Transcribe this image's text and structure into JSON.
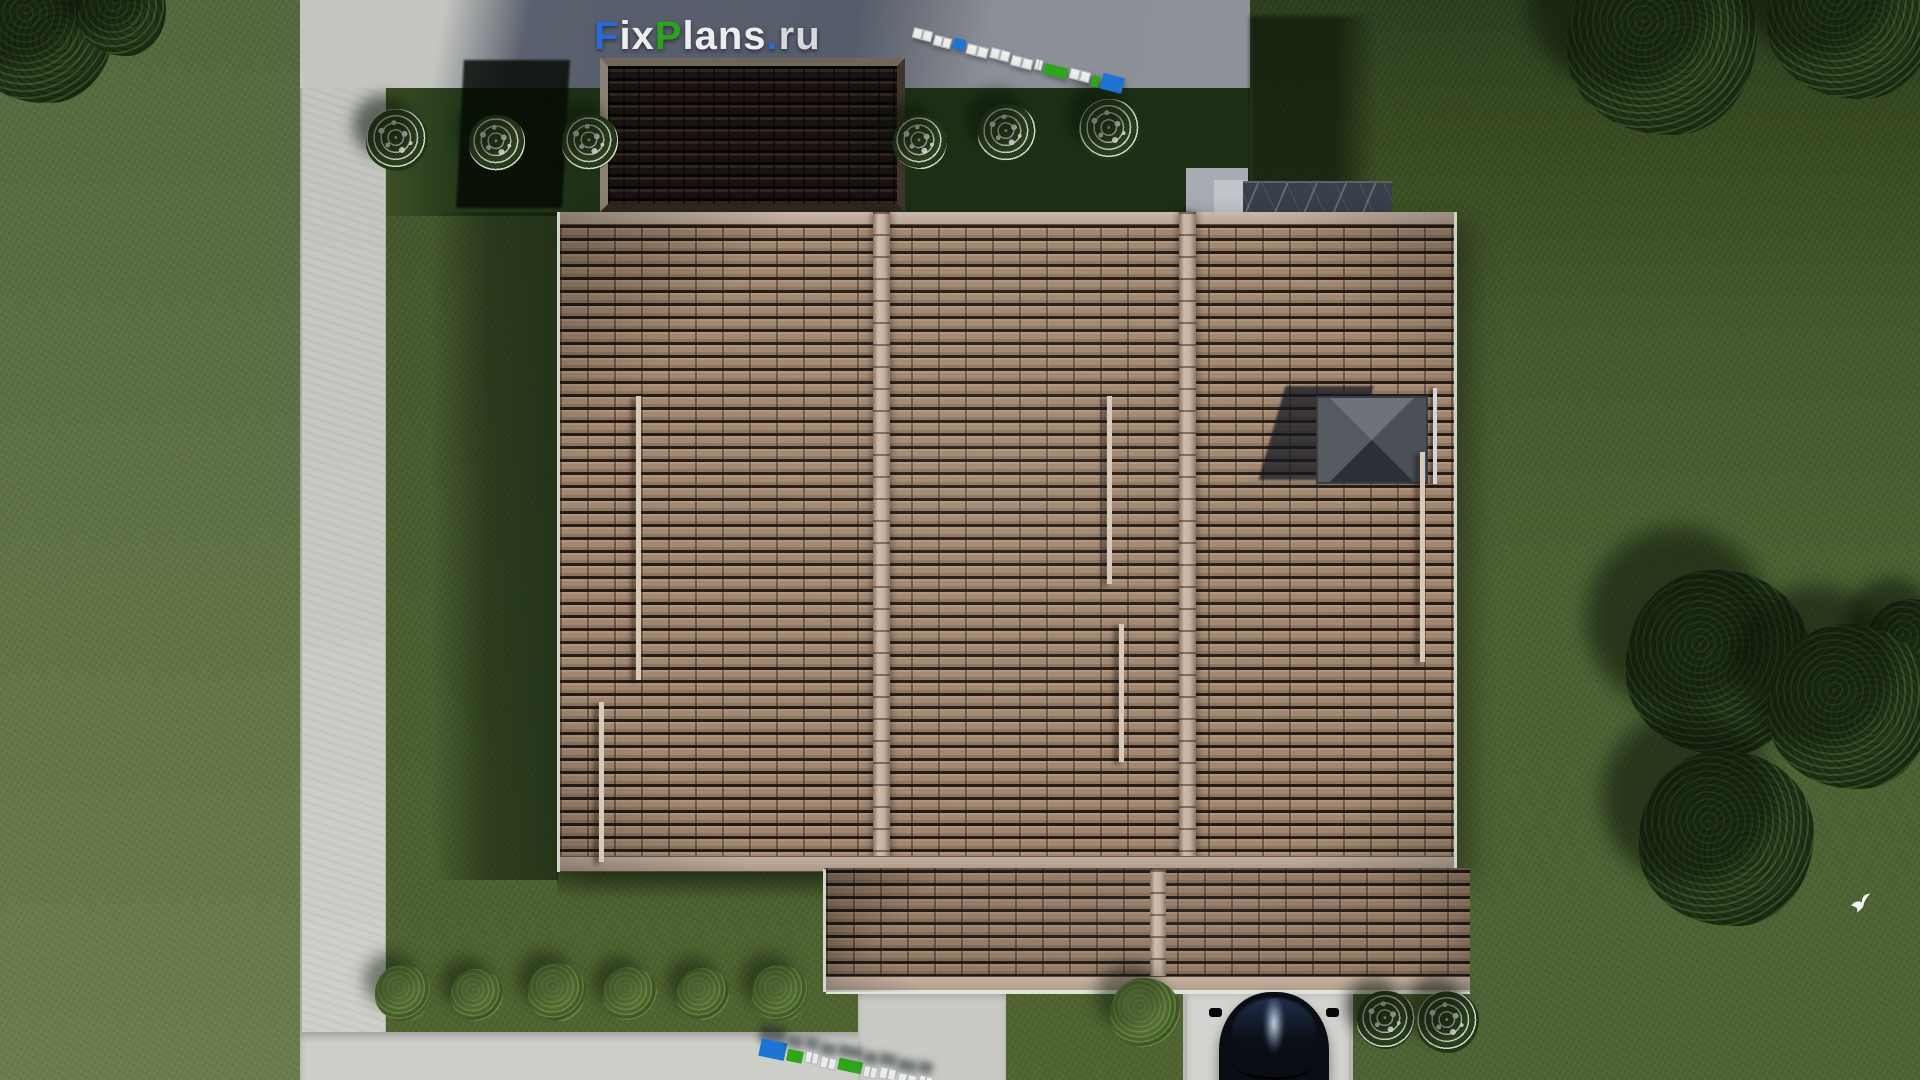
{
  "meta": {
    "canvas_width": 1920,
    "canvas_height": 1080,
    "description": "Aerial top-down 3D architectural render of a single-family house with a brown tiled hip roof, shadowed carport roof, landscaped lawn, concrete walkways, patio, driveway with parked dark car, trees and flowering bushes"
  },
  "watermark": {
    "text": "FixPlans.ru",
    "parts": [
      {
        "text": "F",
        "color": "#2a6ad4"
      },
      {
        "text": "ix",
        "color": "#ebedee"
      },
      {
        "text": "P",
        "color": "#2da21f"
      },
      {
        "text": "lans",
        "color": "#ebedee"
      },
      {
        "text": ".",
        "color": "#2a6ad4"
      },
      {
        "text": "ru",
        "color": "#d7d9dc"
      }
    ]
  },
  "palette": {
    "grass": "#4c6031",
    "grass_light": "#5f7244",
    "grass_shadow": "#1d3015",
    "concrete_path": "#c8c9c4",
    "terrace_dark": "#565c69",
    "roof_tile": "#a0846f",
    "roof_tile_highlight": "#b59a85",
    "roof_ridge": "#c9b6a6",
    "roof_gap": "#241c15",
    "carport_roof": "#191210",
    "marble_wall": "#394049",
    "car_body": "#0b0f16",
    "scalebar_blue": "#1e74d2",
    "scalebar_green": "#2fa51c",
    "scalebar_white": "#eff1ee"
  },
  "roof": {
    "snow_guards": [
      {
        "x": 636,
        "y": 396,
        "h": 284
      },
      {
        "x": 599,
        "y": 702,
        "h": 160
      },
      {
        "x": 1107,
        "y": 396,
        "h": 188
      },
      {
        "x": 1119,
        "y": 624,
        "h": 138
      },
      {
        "x": 1420,
        "y": 452,
        "h": 210
      }
    ],
    "chimney": {
      "x": 1318,
      "y": 398,
      "width": 108,
      "height": 84
    },
    "chimney_shadow": {
      "x": 1272,
      "y": 386,
      "width": 88,
      "height": 94
    },
    "vent_pipe": {
      "x": 1433,
      "y": 388,
      "height": 96
    }
  },
  "vegetation": {
    "trees": [
      {
        "x": 40,
        "y": 28,
        "s": 150
      },
      {
        "x": 122,
        "y": 12,
        "s": 88
      },
      {
        "x": 1662,
        "y": 40,
        "s": 190
      },
      {
        "x": 1852,
        "y": 14,
        "s": 170
      },
      {
        "x": 1912,
        "y": 645,
        "s": 92
      },
      {
        "x": 1718,
        "y": 662,
        "s": 185
      },
      {
        "x": 1850,
        "y": 706,
        "s": 165
      },
      {
        "x": 1726,
        "y": 838,
        "s": 175
      }
    ],
    "bushes": [
      {
        "x": 403,
        "y": 993,
        "s": 56
      },
      {
        "x": 477,
        "y": 995,
        "s": 52
      },
      {
        "x": 557,
        "y": 992,
        "s": 58
      },
      {
        "x": 630,
        "y": 994,
        "s": 54
      },
      {
        "x": 703,
        "y": 994,
        "s": 52
      },
      {
        "x": 780,
        "y": 993,
        "s": 56
      },
      {
        "x": 1145,
        "y": 1013,
        "s": 70
      }
    ],
    "flower_bushes": [
      {
        "x": 397,
        "y": 140,
        "s": 62
      },
      {
        "x": 497,
        "y": 143,
        "s": 56
      },
      {
        "x": 590,
        "y": 142,
        "s": 56
      },
      {
        "x": 920,
        "y": 142,
        "s": 54
      },
      {
        "x": 1007,
        "y": 133,
        "s": 58
      },
      {
        "x": 1110,
        "y": 130,
        "s": 62
      },
      {
        "x": 1386,
        "y": 1020,
        "s": 58
      },
      {
        "x": 1448,
        "y": 1022,
        "s": 62
      }
    ]
  },
  "scalebars": {
    "top": {
      "x": 915,
      "y": 24,
      "angle": 14.5,
      "height": 11,
      "segments": [
        {
          "color": "white",
          "w": 20
        },
        {
          "color": "white",
          "w": 18
        },
        {
          "color": "blue",
          "w": 12
        },
        {
          "color": "white",
          "w": 22
        },
        {
          "color": "white",
          "w": 20
        },
        {
          "color": "white",
          "w": 22
        },
        {
          "color": "white",
          "w": 8
        },
        {
          "color": "green",
          "w": 24
        },
        {
          "color": "white",
          "w": 21
        },
        {
          "color": "green",
          "w": 8
        },
        {
          "color": "blue",
          "w": 22,
          "h": 16
        }
      ]
    },
    "bottom": {
      "x": 762,
      "y": 1038,
      "angle": 12,
      "height": 12,
      "segments": [
        {
          "color": "blue",
          "w": 26,
          "h": 18
        },
        {
          "color": "green",
          "w": 16
        },
        {
          "color": "white",
          "w": 14
        },
        {
          "color": "white",
          "w": 16
        },
        {
          "color": "green",
          "w": 24
        },
        {
          "color": "white",
          "w": 14
        },
        {
          "color": "white",
          "w": 17
        },
        {
          "color": "white",
          "w": 19
        },
        {
          "color": "white",
          "w": 14
        }
      ]
    }
  },
  "car": {
    "x": 1213,
    "y": 992,
    "width": 122,
    "height": 96
  },
  "bird": {
    "x": 1849,
    "y": 891
  }
}
